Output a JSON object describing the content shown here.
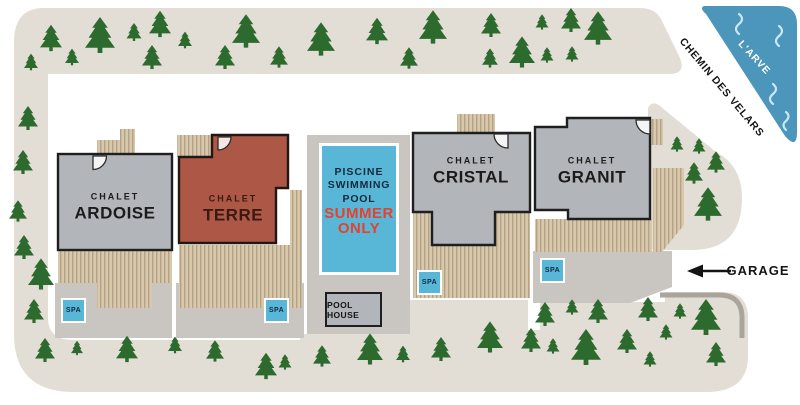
{
  "map_labels": {
    "road_name": "CHEMIN DES VELARS",
    "river_name": "L'ARVE",
    "garage": "GARAGE",
    "pool_house": "POOL HOUSE",
    "spa": "SPA"
  },
  "chalets": {
    "ardoise": {
      "type": "CHALET",
      "name": "ARDOISE"
    },
    "terre": {
      "type": "CHALET",
      "name": "TERRE"
    },
    "cristal": {
      "type": "CHALET",
      "name": "CRISTAL"
    },
    "granit": {
      "type": "CHALET",
      "name": "GRANIT"
    }
  },
  "pool": {
    "name_fr": "PISCINE",
    "name_en_l1": "SWIMMING",
    "name_en_l2": "POOL",
    "season_l1": "SUMMER",
    "season_l2": "ONLY"
  },
  "icons": {
    "tree": "pine-tree-icon",
    "door": "door-swing-icon",
    "garage_arrow": "left-arrow-icon",
    "water": "wave-icon"
  },
  "colors": {
    "road_verge": "#e2ded5",
    "paved_pad": "#c9c6c1",
    "chalet_gray": "#b2b5b9",
    "chalet_terre_red": "#ad5847",
    "terrace_plank_light": "#d8c9ad",
    "terrace_plank_dark": "#b4a286",
    "tree_green": "#2d6a2e",
    "pool_blue": "#58b7d7",
    "river_blue": "#4b96ba",
    "summer_only_red": "#e8402f",
    "navy_text": "#16283c",
    "curb_gray": "#a9a59d"
  }
}
